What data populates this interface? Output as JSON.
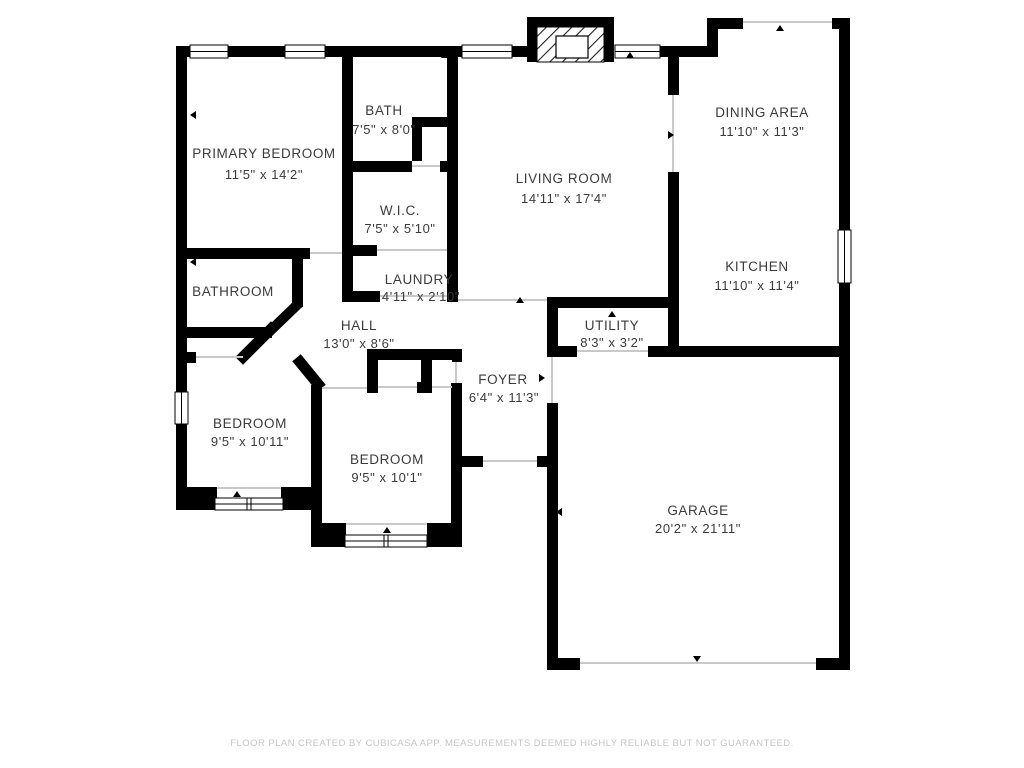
{
  "footer": {
    "text": "FLOOR PLAN CREATED BY CUBICASA APP. MEASUREMENTS DEEMED HIGHLY RELIABLE BUT NOT GUARANTEED."
  },
  "colors": {
    "wall": "#000000",
    "background": "#ffffff",
    "label_text": "#3b3b3b",
    "opening_line": "#c9c9c9",
    "footer_text": "#c7c7c7"
  },
  "rooms": {
    "primary_bedroom": {
      "name": "PRIMARY BEDROOM",
      "dimensions": "11'5\" x 14'2\""
    },
    "bath": {
      "name": "BATH",
      "dimensions": "7'5\" x 8'0\""
    },
    "wic": {
      "name": "W.I.C.",
      "dimensions": "7'5\" x 5'10\""
    },
    "living_room": {
      "name": "LIVING ROOM",
      "dimensions": "14'11\" x 17'4\""
    },
    "dining_area": {
      "name": "DINING AREA",
      "dimensions": "11'10\" x 11'3\""
    },
    "kitchen": {
      "name": "KITCHEN",
      "dimensions": "11'10\" x 11'4\""
    },
    "bathroom": {
      "name": "BATHROOM",
      "dimensions": ""
    },
    "laundry": {
      "name": "LAUNDRY",
      "dimensions": "4'11\" x 2'10\""
    },
    "hall": {
      "name": "HALL",
      "dimensions": "13'0\" x 8'6\""
    },
    "utility": {
      "name": "UTILITY",
      "dimensions": "8'3\" x 3'2\""
    },
    "foyer": {
      "name": "FOYER",
      "dimensions": "6'4\" x 11'3\""
    },
    "bedroom_left": {
      "name": "BEDROOM",
      "dimensions": "9'5\" x 10'11\""
    },
    "bedroom_center": {
      "name": "BEDROOM",
      "dimensions": "9'5\" x 10'1\""
    },
    "garage": {
      "name": "GARAGE",
      "dimensions": "20'2\" x 21'11\""
    }
  }
}
